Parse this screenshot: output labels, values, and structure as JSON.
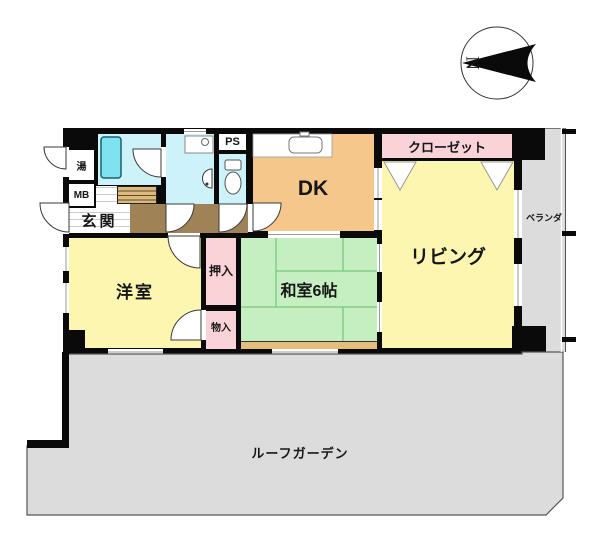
{
  "plan": {
    "title": "floor-plan",
    "compass_label": "N",
    "rooms": {
      "bath_small_label": "湯",
      "meter_box_label": "MB",
      "entrance_label": "玄関",
      "pipe_space_label": "PS",
      "dining_kitchen_label": "DK",
      "closet_label": "クローゼット",
      "living_label": "リビング",
      "veranda_label": "ベランダ",
      "western_room_label": "洋室",
      "oshiire_label": "押入",
      "storage_label": "物入",
      "japanese_room_label": "和室6帖",
      "roof_garden_label": "ルーフガーデン"
    },
    "colors": {
      "wall": "#0a0a0a",
      "room_yellow": "#fcf6b0",
      "tatami_green": "#c5efc1",
      "tatami_line": "#77c87e",
      "dk_orange": "#f6c78b",
      "closet_pink": "#fad3d8",
      "wet_cyan": "#cdf2f9",
      "bathtub_cyan": "#7fe3ef",
      "corridor_brown": "#a08257",
      "outdoor_gray": "#dcdcdc",
      "wood_strip_tan": "#e5bd7d"
    }
  }
}
